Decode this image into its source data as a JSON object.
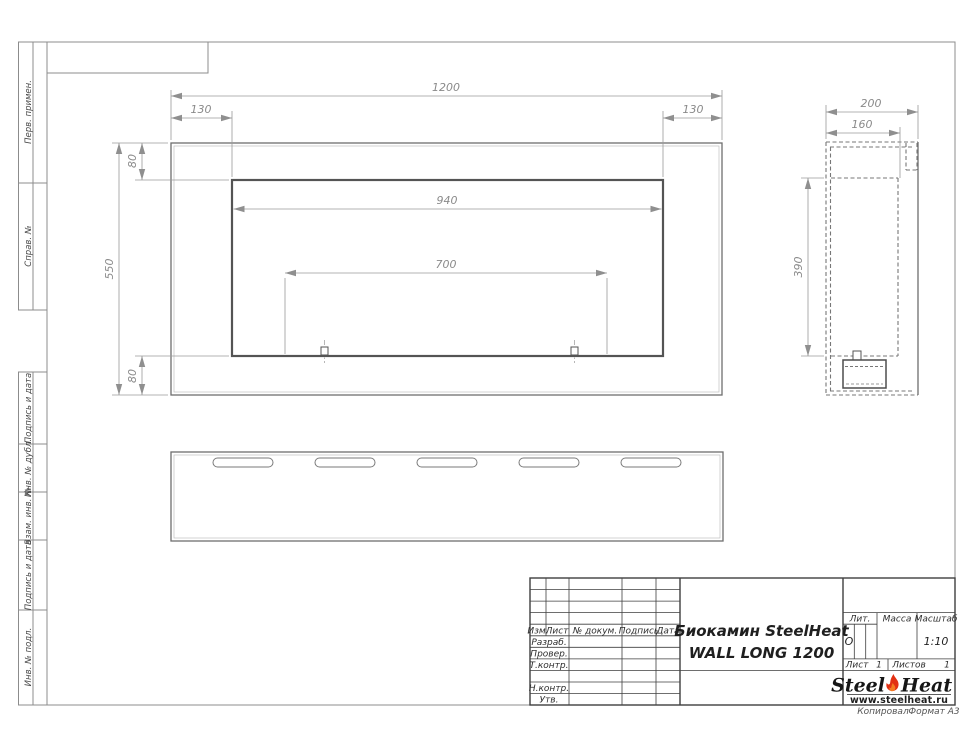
{
  "document": {
    "name_line1": "Биокамин SteelHeat",
    "name_line2": "WALL LONG 1200"
  },
  "dimensions": {
    "front": {
      "width": "1200",
      "left_inset": "130",
      "right_inset": "130",
      "opening_width": "940",
      "mount_span": "700",
      "height": "550",
      "top_inset": "80",
      "bottom_inset": "80"
    },
    "side": {
      "depth": "200",
      "inner_depth": "160",
      "opening_height": "390"
    }
  },
  "frame": {
    "labels": [
      "Перв. примен.",
      "Справ. №",
      "Подпись и дата",
      "Инв. № дубл.",
      "Взам. инв. №",
      "Подпись и дата",
      "Инв. № подл."
    ]
  },
  "title_block": {
    "columns": [
      "Изм.",
      "Лист",
      "№ докум.",
      "Подпись",
      "Дата"
    ],
    "rows": [
      "Разраб.",
      "Провер.",
      "Т.контр.",
      "Н.контр.",
      "Утв."
    ],
    "lit_label": "Лит.",
    "lit_value": "О",
    "mass_label": "Масса",
    "scale_label": "Масштаб",
    "scale_value": "1:10",
    "sheet_label": "Лист",
    "sheet_value": "1",
    "sheets_label": "Листов",
    "sheets_value": "1",
    "logo": {
      "part1": "Steel",
      "part2": "Heat",
      "url": "www.steelheat.ru"
    },
    "footer": {
      "left": "Копировал",
      "right": "Формат А3"
    }
  },
  "colors": {
    "flame_red": "#e23013",
    "flame_orange": "#f47b20",
    "object_line": "#6e6e6e",
    "dim_text": "#8a8a8a"
  }
}
